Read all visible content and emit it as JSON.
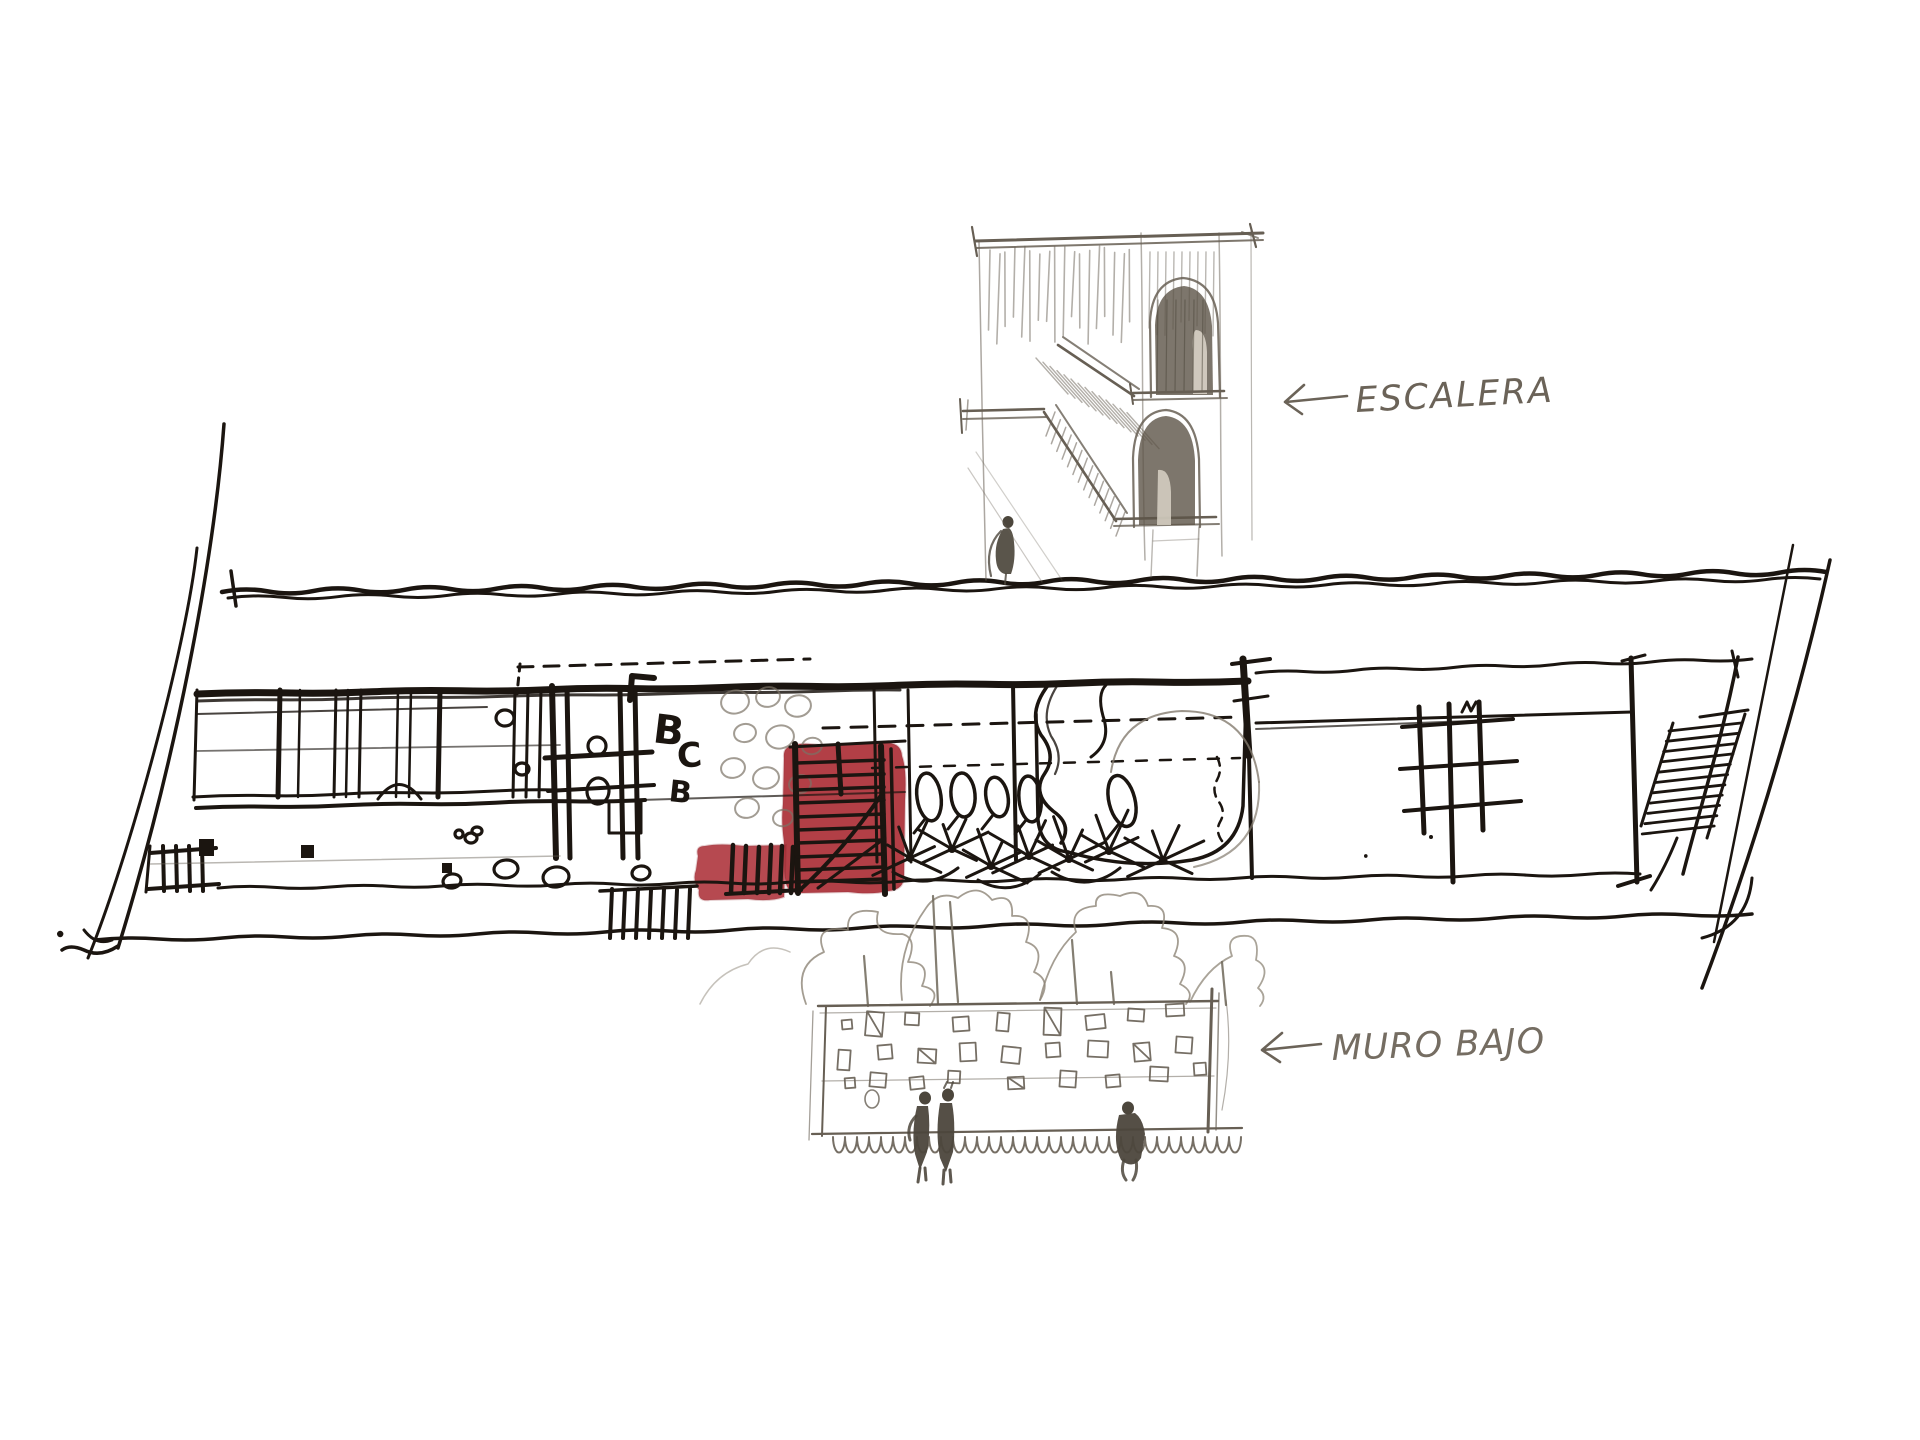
{
  "palette": {
    "paper": "#ffffff",
    "ink": "#1b1510",
    "pencil": "#675f54",
    "pencil_light": "#8d8577",
    "pencil_dark": "#4c463c",
    "marker_red": "#ad3139",
    "marker_red_edge": "#8c252d"
  },
  "annotations": {
    "escalera": {
      "label": "ESCALERA",
      "arrow": "left"
    },
    "muro_bajo": {
      "label": "MURO BAJO",
      "arrow": "left"
    }
  },
  "plan": {
    "room_labels": [
      "B",
      "C",
      "B"
    ]
  }
}
